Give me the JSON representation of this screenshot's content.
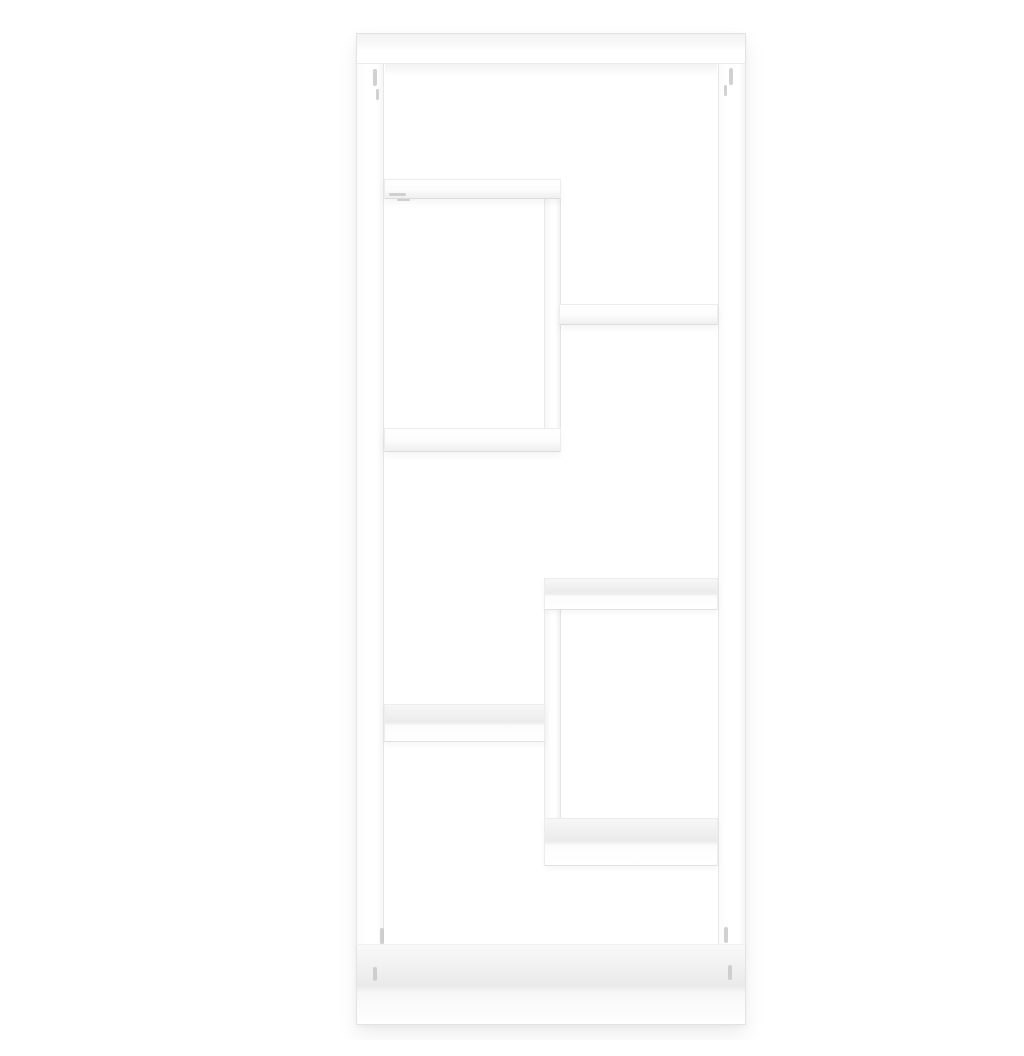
{
  "scene": {
    "type": "product-photo",
    "description": "Front view of a white geometric wall-mounted display shelf with six open compartments on a plain white background",
    "background_color": "#ffffff"
  },
  "palette": {
    "background": "#ffffff",
    "surface": "#ffffff",
    "edge": "#e3e3e3",
    "shade": "#ebebeb",
    "floor_shade": "#eaeaea",
    "mark": "#c6c6c6",
    "shadow": "rgba(0,0,0,0.07)"
  },
  "shelf": {
    "object": "wall-shelf",
    "color": "white",
    "frame": {
      "x": 316,
      "y": 17,
      "width": 390,
      "height": 992,
      "panel_thickness": 28
    },
    "parts": [
      {
        "name": "frame-outline",
        "style": "frame-outline",
        "x": 316,
        "y": 17,
        "w": 390,
        "h": 992
      },
      {
        "name": "frame-left-panel",
        "style": "panel-v",
        "x": 316,
        "y": 17,
        "w": 28,
        "h": 992
      },
      {
        "name": "frame-right-panel",
        "style": "panel-v",
        "x": 678,
        "y": 17,
        "w": 28,
        "h": 992
      },
      {
        "name": "frame-top-panel",
        "style": "panel-h",
        "x": 316,
        "y": 17,
        "w": 390,
        "h": 31
      },
      {
        "name": "frame-bottom-panel",
        "style": "panel-floor",
        "x": 316,
        "y": 928,
        "w": 390,
        "h": 81
      },
      {
        "name": "top-panel-inner-shadow",
        "style": "shade-top",
        "x": 345,
        "y": 48,
        "w": 332,
        "h": 13
      },
      {
        "name": "divider-upper",
        "style": "divider",
        "x": 504,
        "y": 180,
        "w": 17,
        "h": 236
      },
      {
        "name": "divider-lower",
        "style": "divider",
        "x": 504,
        "y": 590,
        "w": 17,
        "h": 216
      },
      {
        "name": "shelf-top-left",
        "style": "shelf-under",
        "x": 344,
        "y": 163,
        "w": 177,
        "h": 20
      },
      {
        "name": "shelf-upper-right",
        "style": "shelf-under",
        "x": 519,
        "y": 288,
        "w": 159,
        "h": 21
      },
      {
        "name": "shelf-middle-left",
        "style": "shelf-under",
        "x": 344,
        "y": 412,
        "w": 177,
        "h": 24
      },
      {
        "name": "shelf-middle-right",
        "style": "shelf-over",
        "x": 504,
        "y": 562,
        "w": 174,
        "h": 32
      },
      {
        "name": "shelf-lower-left",
        "style": "shelf-over",
        "x": 344,
        "y": 688,
        "w": 161,
        "h": 38
      },
      {
        "name": "shelf-bottom-right",
        "style": "shelf-over",
        "x": 504,
        "y": 802,
        "w": 174,
        "h": 48
      }
    ],
    "fitting_marks": [
      {
        "x": 333,
        "y": 53,
        "w": 4,
        "h": 17
      },
      {
        "x": 336,
        "y": 73,
        "w": 3,
        "h": 11
      },
      {
        "x": 689,
        "y": 52,
        "w": 4,
        "h": 17
      },
      {
        "x": 684,
        "y": 69,
        "w": 3,
        "h": 11
      },
      {
        "x": 349,
        "y": 177,
        "w": 17,
        "h": 3
      },
      {
        "x": 357,
        "y": 183,
        "w": 13,
        "h": 2
      },
      {
        "x": 340,
        "y": 912,
        "w": 4,
        "h": 16
      },
      {
        "x": 333,
        "y": 951,
        "w": 4,
        "h": 14
      },
      {
        "x": 684,
        "y": 911,
        "w": 4,
        "h": 16
      },
      {
        "x": 688,
        "y": 949,
        "w": 4,
        "h": 15
      }
    ]
  }
}
